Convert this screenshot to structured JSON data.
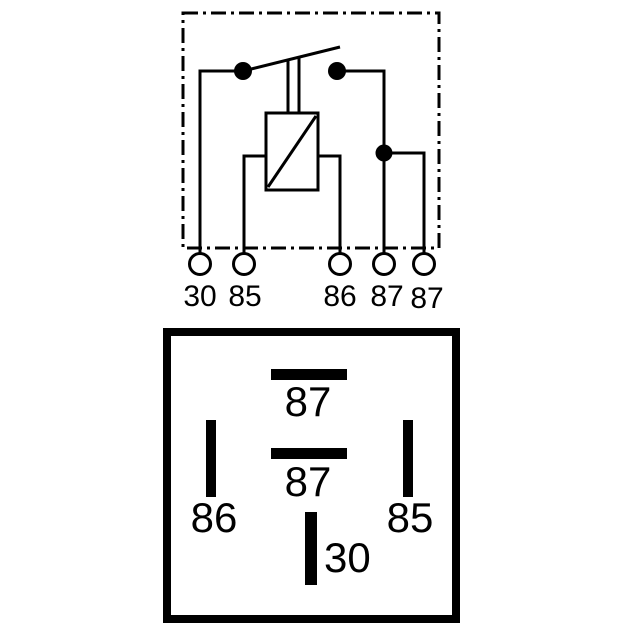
{
  "colors": {
    "line": "#000000",
    "background": "#ffffff"
  },
  "schematic": {
    "terminal_labels": [
      "30",
      "85",
      "86",
      "87",
      "87"
    ]
  },
  "pin_layout": {
    "pin_labels": {
      "top": "87",
      "center": "87",
      "left": "86",
      "right": "85",
      "bottom": "30"
    }
  }
}
